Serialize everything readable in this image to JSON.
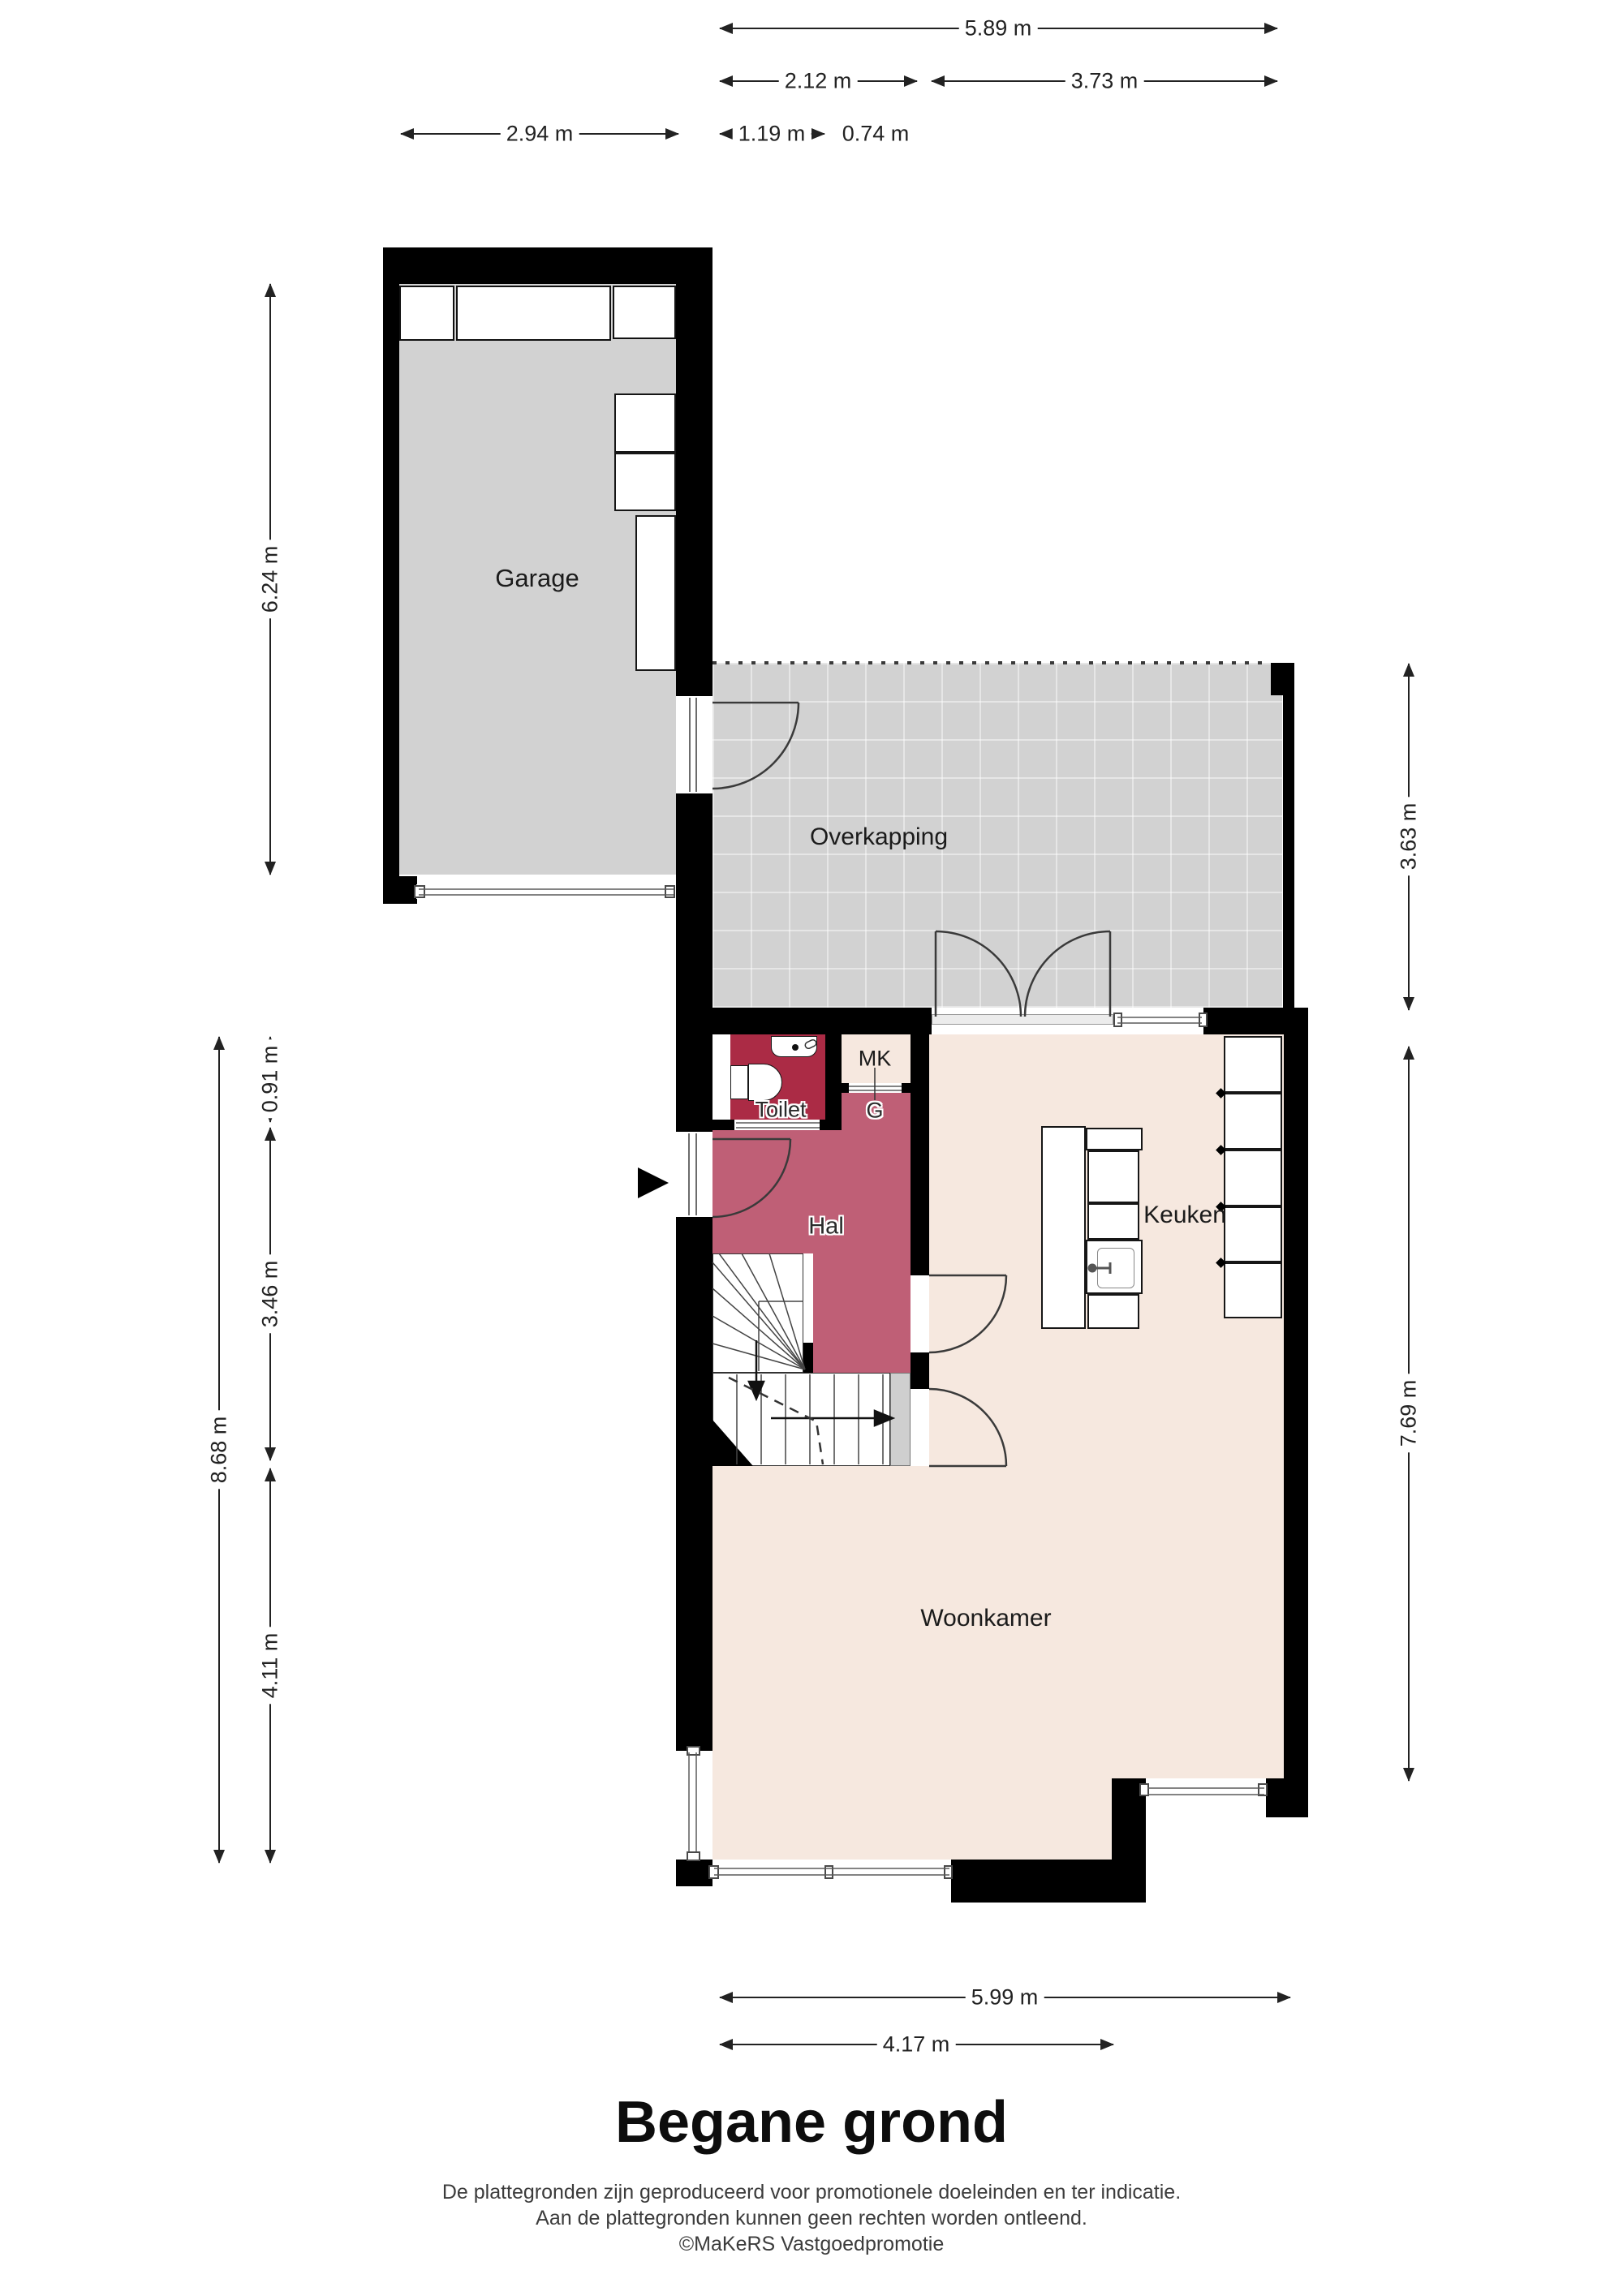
{
  "title": "Begane grond",
  "footer": {
    "line1": "De plattegronden zijn geproduceerd voor promotionele doeleinden en ter indicatie.",
    "line2": "Aan de plattegronden kunnen geen rechten worden ontleend.",
    "line3": "©MaKeRS Vastgoedpromotie"
  },
  "rooms": {
    "garage": "Garage",
    "overkapping": "Overkapping",
    "toilet": "Toilet",
    "mk": "MK",
    "g": "G",
    "hal": "Hal",
    "keuken": "Keuken",
    "woonkamer": "Woonkamer"
  },
  "dimensions": {
    "top_total": "5.89 m",
    "top_hal": "2.12 m",
    "top_keuken": "3.73 m",
    "top_garage": "2.94 m",
    "top_toilet": "1.19 m",
    "top_mk": "0.74 m",
    "left_garage": "6.24 m",
    "left_total": "8.68 m",
    "left_toilet": "0.91 m",
    "left_hal": "3.46 m",
    "left_woonkamer": "4.11 m",
    "right_overkapping": "3.63 m",
    "right_house": "7.69 m",
    "bottom_total": "5.99 m",
    "bottom_woonkamer": "4.17 m"
  },
  "colors": {
    "wall": "#000000",
    "garage_floor": "#d2d2d2",
    "overkapping_floor": "#d2d2d2",
    "living_floor": "#f6e8df",
    "toilet_floor": "#ab2b45",
    "hal_floor": "#bf5f76"
  }
}
